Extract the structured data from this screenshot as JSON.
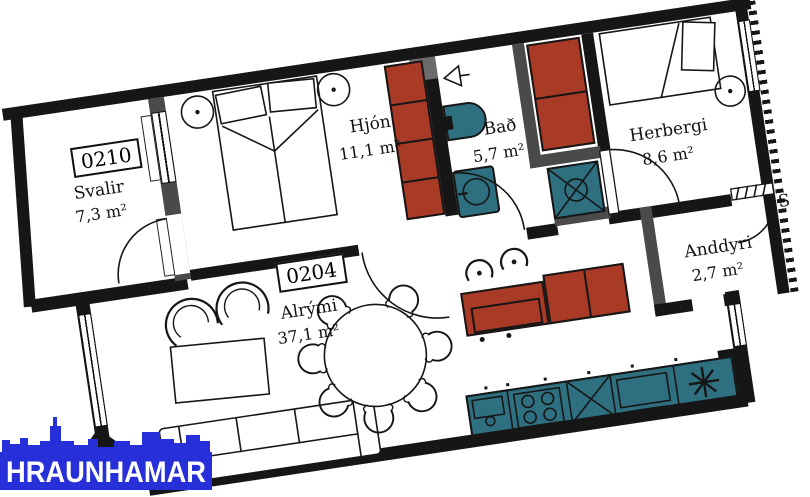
{
  "plan": {
    "units": [
      {
        "number": "0210",
        "room": "Svalir",
        "area": "7,3 m²"
      },
      {
        "number": "0204",
        "room": "Alrými",
        "area": "37,1 m²"
      }
    ],
    "rooms": [
      {
        "name": "Hjón",
        "area": "11,1 m²"
      },
      {
        "name": "Bað",
        "area": "5,7 m²"
      },
      {
        "name": "Herbergi",
        "area": "8,6 m²"
      },
      {
        "name": "Anddyri",
        "area": "2,7 m²"
      }
    ],
    "stairwell_label": "S",
    "elements": [
      "double-bed",
      "single-bed",
      "nightstand",
      "wardrobe",
      "toilet",
      "washbasin",
      "shower",
      "kitchen-counter",
      "cooktop",
      "oven",
      "dishwasher",
      "freezer",
      "kitchen-island",
      "bar-stool",
      "dining-table",
      "dining-chair",
      "sofa",
      "armchair",
      "coffee-table",
      "door-swing",
      "window"
    ],
    "colors": {
      "wall_black": "#161616",
      "wall_gray": "#4a4a4a",
      "cabinet_red": "#a93a25",
      "fixture_teal": "#2e6f80",
      "logo_blue": "#2730d8"
    }
  },
  "logo": {
    "text": "HRAUNHAMAR"
  }
}
